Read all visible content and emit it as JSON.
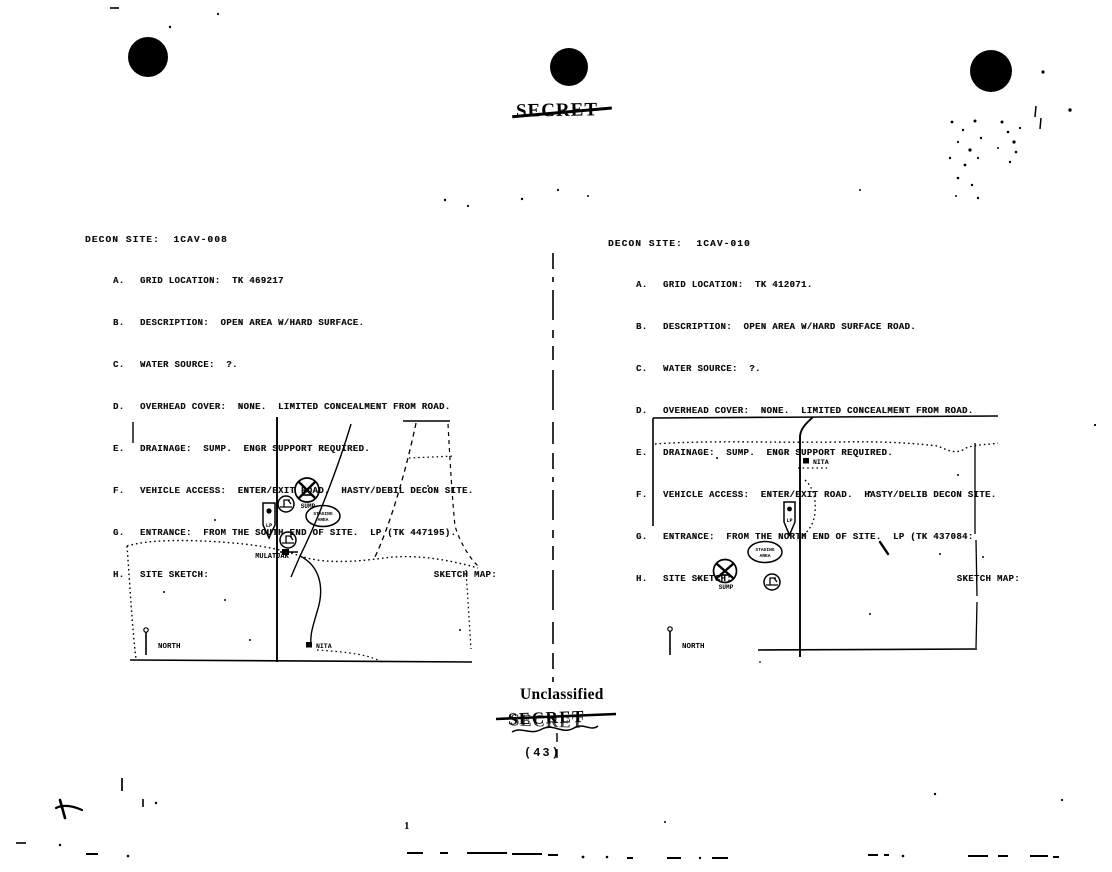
{
  "stamps": {
    "classification_top": "SECRET",
    "declassified_label": "Unclassified",
    "crossed_stamp": "SECRET",
    "page_count": "(43)",
    "page_number": "1"
  },
  "sites": [
    {
      "heading": "DECON SITE:  1CAV-008",
      "items": [
        {
          "letter": "A.",
          "text": "GRID LOCATION:  TK 469217"
        },
        {
          "letter": "B.",
          "text": "DESCRIPTION:  OPEN AREA W/HARD SURFACE."
        },
        {
          "letter": "C.",
          "text": "WATER SOURCE:  ?."
        },
        {
          "letter": "D.",
          "text": "OVERHEAD COVER:  NONE.  LIMITED CONCEALMENT FROM ROAD."
        },
        {
          "letter": "E.",
          "text": "DRAINAGE:  SUMP.  ENGR SUPPORT REQUIRED."
        },
        {
          "letter": "F.",
          "text": "VEHICLE ACCESS:  ENTER/EXIT ROAD.  HASTY/DEBIL DECON SITE."
        },
        {
          "letter": "G.",
          "text": "ENTRANCE:  FROM THE SOUTH END OF SITE.  LP (TK 447195)."
        },
        {
          "letter": "H.",
          "text": "SITE SKETCH:",
          "right_label": "SKETCH MAP:"
        }
      ],
      "map": {
        "town": "MULATJAK",
        "settlement": "NITA",
        "north_label": "NORTH",
        "sump_label": "SUMP",
        "staging_line1": "STAGING",
        "staging_line2": "AREA",
        "lp_label": "LP"
      }
    },
    {
      "heading": "DECON SITE:  1CAV-010",
      "items": [
        {
          "letter": "A.",
          "text": "GRID LOCATION:  TK 412071."
        },
        {
          "letter": "B.",
          "text": "DESCRIPTION:  OPEN AREA W/HARD SURFACE ROAD."
        },
        {
          "letter": "C.",
          "text": "WATER SOURCE:  ?."
        },
        {
          "letter": "D.",
          "text": "OVERHEAD COVER:  NONE.  LIMITED CONCEALMENT FROM ROAD."
        },
        {
          "letter": "E.",
          "text": "DRAINAGE:  SUMP.  ENGR SUPPORT REQUIRED."
        },
        {
          "letter": "F.",
          "text": "VEHICLE ACCESS:  ENTER/EXIT ROAD.  HASTY/DELIB DECON SITE."
        },
        {
          "letter": "G.",
          "text": "ENTRANCE:  FROM THE NORTH END OF SITE.  LP (TK 437084:"
        },
        {
          "letter": "H.",
          "text": "SITE SKETCH:",
          "right_label": "SKETCH MAP:"
        }
      ],
      "map": {
        "settlement": "NITA",
        "north_label": "NORTH",
        "sump_label": "SUMP",
        "staging_line1": "STAGING",
        "staging_line2": "AREA",
        "lp_label": "LP"
      }
    }
  ],
  "ink_color": "#0b0b0b",
  "paper_color": "#ffffff"
}
